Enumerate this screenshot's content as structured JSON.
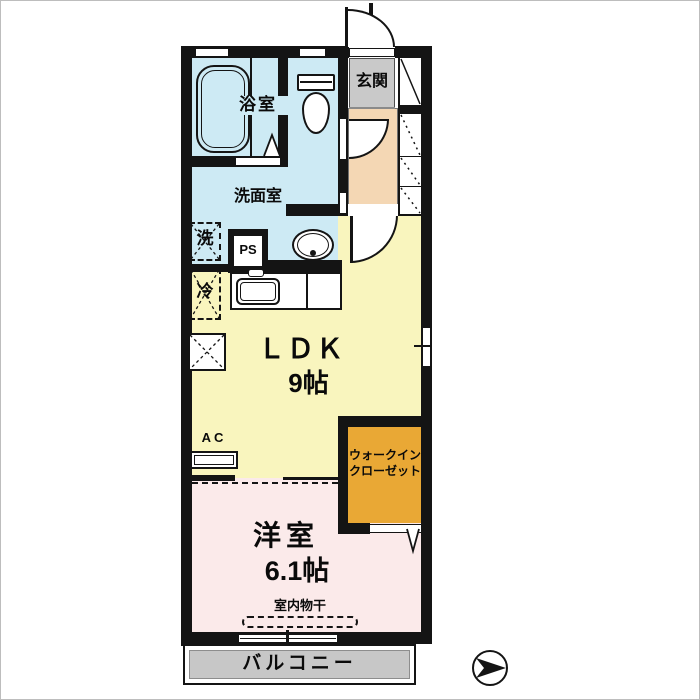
{
  "app": {
    "type": "apartment-floor-plan"
  },
  "rooms": {
    "bathroom": {
      "label": "浴室"
    },
    "entrance": {
      "label": "玄関"
    },
    "washroom": {
      "label": "洗面室"
    },
    "ldk": {
      "label": "ＬＤＫ",
      "size": "9帖"
    },
    "walk_in_closet": {
      "label_line1": "ウォークイン",
      "label_line2": "クローゼット"
    },
    "bedroom": {
      "label": "洋室",
      "size": "6.1帖"
    },
    "balcony": {
      "label": "バルコニー"
    }
  },
  "fixtures": {
    "washing_machine": {
      "label": "洗"
    },
    "pipe_space": {
      "label": "PS"
    },
    "refrigerator": {
      "label": "冷"
    },
    "air_conditioner": {
      "label": "AC"
    },
    "indoor_drying": {
      "label": "室内物干"
    }
  },
  "icons": {
    "compass": "north-arrow-pointing-right",
    "bathtub": "bathtub-top-view",
    "toilet": "toilet-top-view",
    "washbasin": "washbasin-top-view",
    "kitchen_sink": "kitchen-sink-top-view",
    "doors": "quarter-circle-swing-arcs"
  },
  "colors": {
    "wet_area": "#cdeaf4",
    "ldk": "#f9f5be",
    "bedroom": "#fbeaea",
    "closet": "#e9a835",
    "hall": "#f4d7b4",
    "entrance_floor": "#c9c9c9",
    "balcony": "#c7c7c7",
    "wall": "#141414"
  }
}
